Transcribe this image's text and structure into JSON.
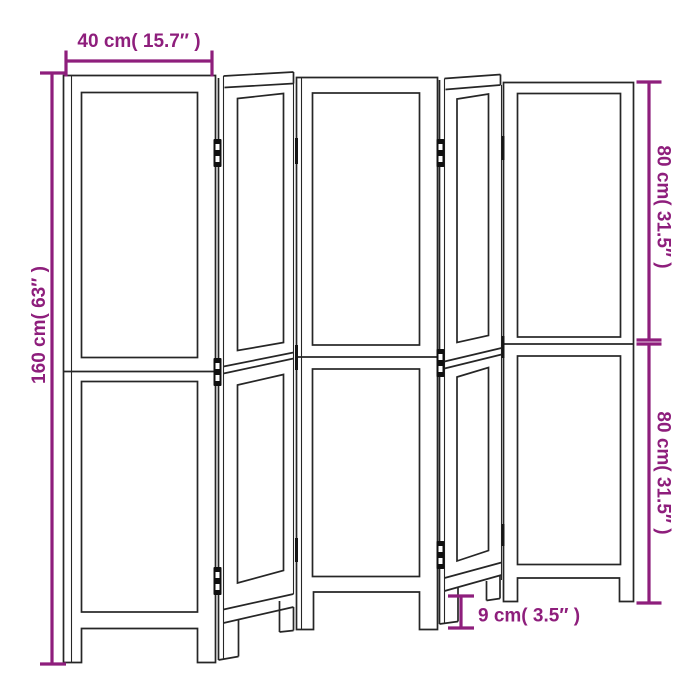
{
  "figure": {
    "kind": "furniture dimension line drawing",
    "panel_count": "5"
  },
  "colors": {
    "dimension_accent": "#8e1e7c",
    "drawing_line": "#262626",
    "background": "#ffffff"
  },
  "dimensions": {
    "panel_width": "40 cm( 15.7″ )",
    "total_height": "160 cm( 63″ )",
    "upper_section_height": "80 cm( 31.5″ )",
    "lower_section_height": "80 cm( 31.5″ )",
    "leg_height": "9 cm( 3.5″ )"
  }
}
